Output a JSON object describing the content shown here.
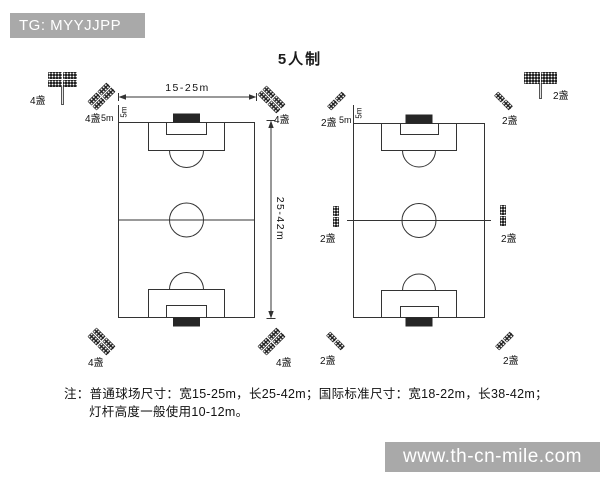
{
  "watermarks": {
    "top_left": "TG: MYYJJPP",
    "bottom_right": "www.th-cn-mile.com"
  },
  "title": "5人制",
  "colors": {
    "watermark_bg": "#a9a9a9",
    "line": "#333333",
    "goal_fill": "#262626"
  },
  "left_field": {
    "width_label": "15-25m",
    "length_label": "25-42m",
    "side_offset_label": "5m",
    "end_offset_label": "5m",
    "corner_light_label": "4盏",
    "pole_light_label": "4盏"
  },
  "right_field": {
    "side_offset_label": "5m",
    "end_offset_label": "5m",
    "corner_light_label": "2盏",
    "side_light_label": "2盏",
    "pole_light_label": "2盏"
  },
  "note": {
    "line1": "注：普通球场尺寸：宽15-25m，长25-42m；国际标准尺寸：宽18-22m，长38-42m；",
    "line2": "灯杆高度一般使用10-12m。"
  }
}
